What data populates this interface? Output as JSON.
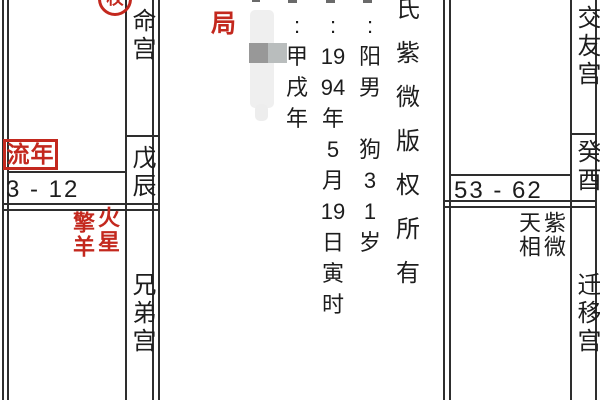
{
  "app": {
    "background": "#ffffff",
    "accent_red": "#c3281e",
    "text_color": "#1d1d1d",
    "border_color": "#2e2e2e"
  },
  "palaces": {
    "ming": {
      "name": "命宫",
      "stem_branch": "戊辰",
      "annual_label": "流年",
      "age_range": "3 - 12",
      "transformation_marker": "权"
    },
    "brothers": {
      "name": "兄弟宫",
      "stars": [
        "擎羊",
        "火星"
      ]
    },
    "friends": {
      "name": "交友宫",
      "stem_branch": "癸酉",
      "age_range": "53 - 62"
    },
    "migration": {
      "name": "迁移宫",
      "stars": [
        "天相",
        "紫微"
      ]
    }
  },
  "center": {
    "ju_label": "局",
    "lunar_column": [
      ":",
      "甲",
      "戌",
      "年"
    ],
    "solar_column": [
      ":",
      "19",
      "94",
      "年",
      "5",
      "月",
      "19",
      "日",
      "寅",
      "时"
    ],
    "gender_column": [
      ":",
      "阳",
      "男",
      "",
      "狗",
      "3",
      "1",
      "岁"
    ],
    "copyright_column": [
      "氏",
      "紫",
      "微",
      "版",
      "权",
      "所",
      "有"
    ]
  }
}
